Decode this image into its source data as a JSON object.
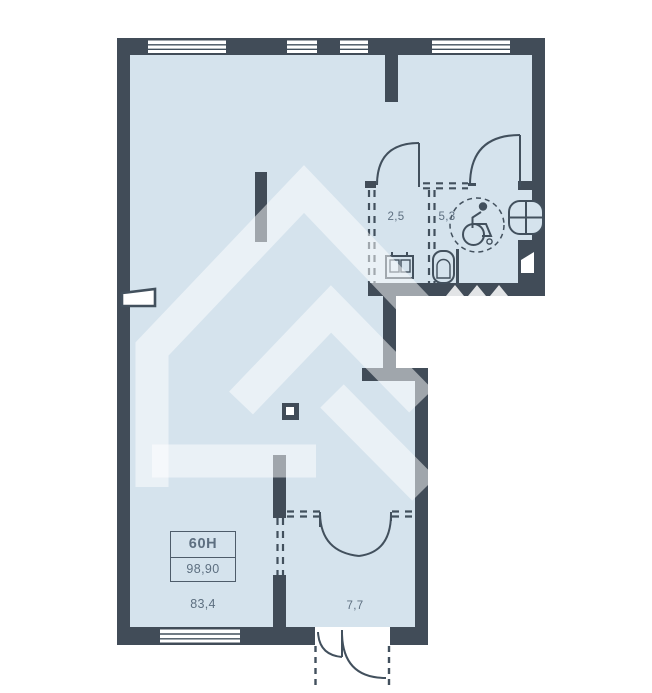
{
  "plan": {
    "unit": {
      "number": "60Н",
      "total_area": "98,90"
    },
    "areas": {
      "main": "83,4",
      "entry": "7,7",
      "wc_small": "2,5",
      "wc_large": "5,3"
    },
    "icons": {
      "wheelchair": "wheelchair-accessible-icon",
      "toilet": "toilet-icon",
      "sink": "sink-icon",
      "washbasin": "washbasin-icon"
    },
    "colors": {
      "wall": "#414c58",
      "room": "#d5e3ed",
      "line": "#42505d",
      "text": "#5d6f80",
      "watermark": "rgba(255,255,255,0.5)"
    }
  }
}
